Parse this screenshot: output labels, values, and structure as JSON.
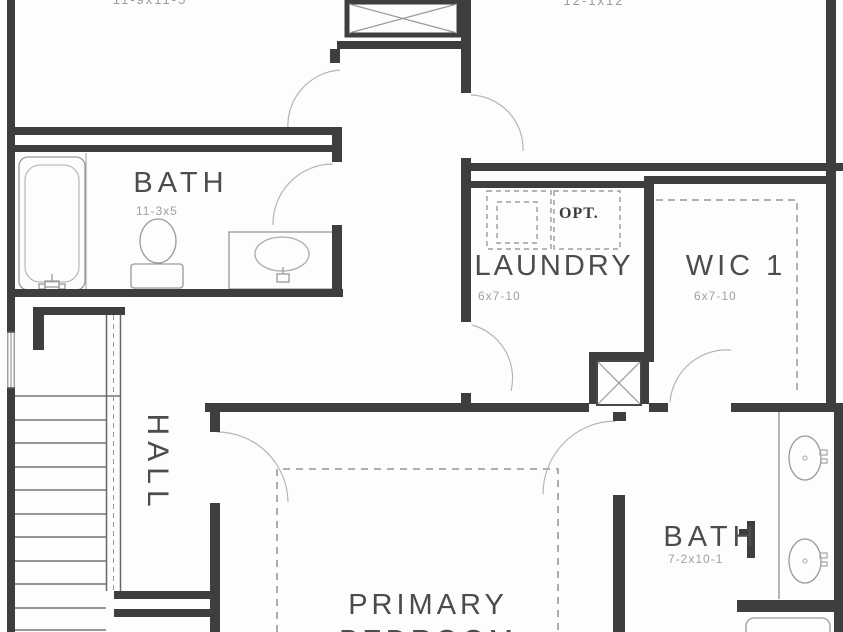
{
  "rooms": {
    "bedroom_top_left": {
      "dim": "11-9x11-5"
    },
    "bedroom_top_right": {
      "dim": "12-1x12"
    },
    "bath_upper": {
      "label": "BATH",
      "dim": "11-3x5"
    },
    "laundry": {
      "label": "LAUNDRY",
      "dim": "6x7-10",
      "opt": "OPT."
    },
    "wic1": {
      "label": "WIC 1",
      "dim": "6x7-10"
    },
    "hall": {
      "label": "HALL"
    },
    "bath_primary": {
      "label": "BATH",
      "dim": "7-2x10-1"
    },
    "primary_bedroom": {
      "line1": "PRIMARY",
      "line2": "BEDROOM"
    }
  },
  "colors": {
    "wall": "#3e3e3e",
    "fixture": "#9a9a9a",
    "door_arc": "#b5b5b5",
    "dashed_line": "#818181",
    "label_text": "#4c4c4c",
    "dim_text": "#a0a0a0",
    "background": "#fdfdfd"
  }
}
